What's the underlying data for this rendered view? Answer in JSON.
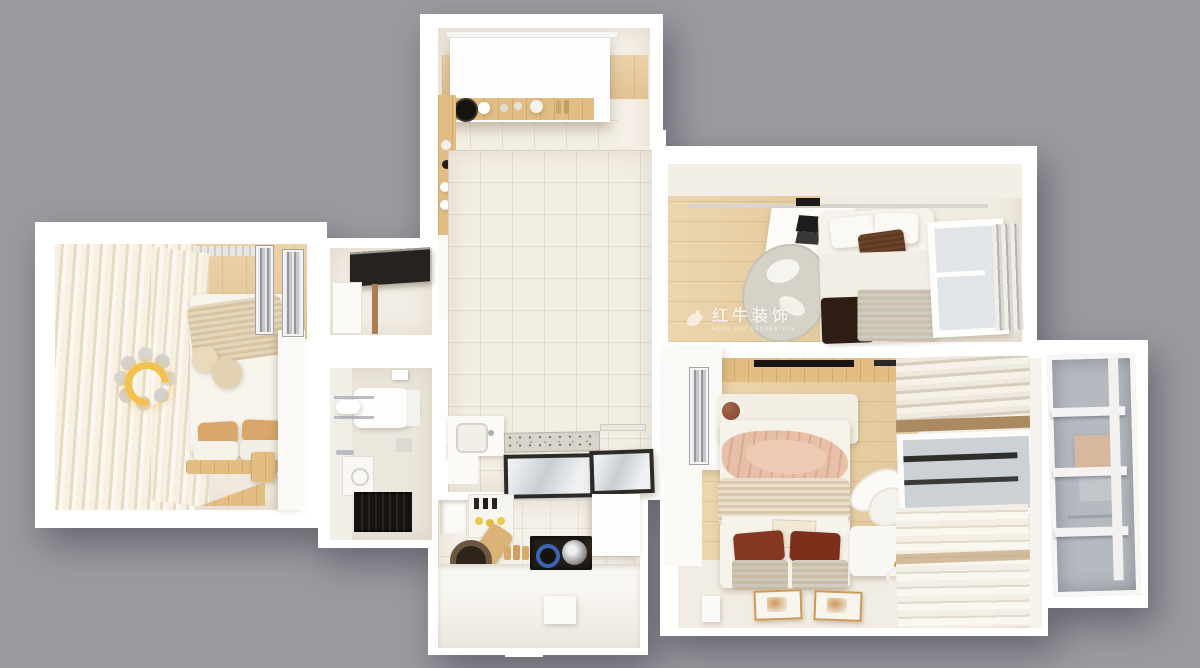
{
  "scene": {
    "type": "3d-floorplan-top-view",
    "background_color": "#9b9aa1",
    "watermark": {
      "logo": "bull-icon",
      "text": "红牛装饰",
      "subtext": "HONG NIU DECORATION"
    }
  },
  "palette": {
    "wall_white": "#ffffff",
    "floor_wood": "#e9cb9c",
    "floor_tile": "#f3eee4",
    "curtain_cream": "#f3ebdb",
    "blanket_blush": "#e7bda6",
    "pillow_rust": "#833621",
    "blanket_dark_brown": "#2f1f15",
    "appliance_black": "#24201c",
    "lamp_yellow": "#f2c14e",
    "glass_gray": "#b6bac1"
  },
  "rooms": [
    {
      "id": "bedroom-left",
      "label": "left bedroom with wrap-around curtains",
      "items": [
        "sheer curtains",
        "bed with knit throw",
        "round cushions",
        "tan and white pillows",
        "crescent moon lamp",
        "wardrobe",
        "mirror panels",
        "radiator",
        "wood tray rug"
      ]
    },
    {
      "id": "dining-room",
      "label": "dining room and coffee bar",
      "items": [
        "white roller canopy",
        "wood balcony strip",
        "coffee machine counter",
        "tall wood cabinet",
        "dining table with plate and plant",
        "bench",
        "two chairs",
        "two wall frames",
        "wall niches"
      ]
    },
    {
      "id": "bathroom",
      "label": "bathroom and hob room",
      "items": [
        "black range hood",
        "toilet",
        "towel shelf",
        "washer",
        "chrome faucet",
        "dark shower mat",
        "pass-through window"
      ]
    },
    {
      "id": "hallway",
      "label": "hallway",
      "items": [
        "wash basin",
        "speckled door mat",
        "glass floor panels",
        "towel rail"
      ]
    },
    {
      "id": "kitchen",
      "label": "kitchen",
      "items": [
        "open shelf box",
        "wall rack with lemons and bottles",
        "cutting board",
        "dark pan",
        "bread",
        "cooktop niche with blue burner and wok",
        "fridge cabinet",
        "island counter"
      ]
    },
    {
      "id": "bedroom-top-right",
      "label": "bedroom with desk",
      "items": [
        "track light",
        "white desk with laptop",
        "gray chair on rug",
        "double bed",
        "brown accent pillow",
        "dark brown blanket",
        "gray throw",
        "window",
        "vertical blinds"
      ]
    },
    {
      "id": "bedroom-master",
      "label": "master bedroom",
      "items": [
        "wardrobe with mirror",
        "headboard with brown ball",
        "blush blanket",
        "knit blanket",
        "rust pillows",
        "gray foot cushions",
        "two floor frames",
        "white armchair",
        "side cabinet",
        "round tray",
        "layered drapes",
        "window"
      ]
    },
    {
      "id": "balcony",
      "label": "glazed balcony",
      "items": [
        "white mullioned glazing",
        "storage boxes"
      ]
    }
  ]
}
